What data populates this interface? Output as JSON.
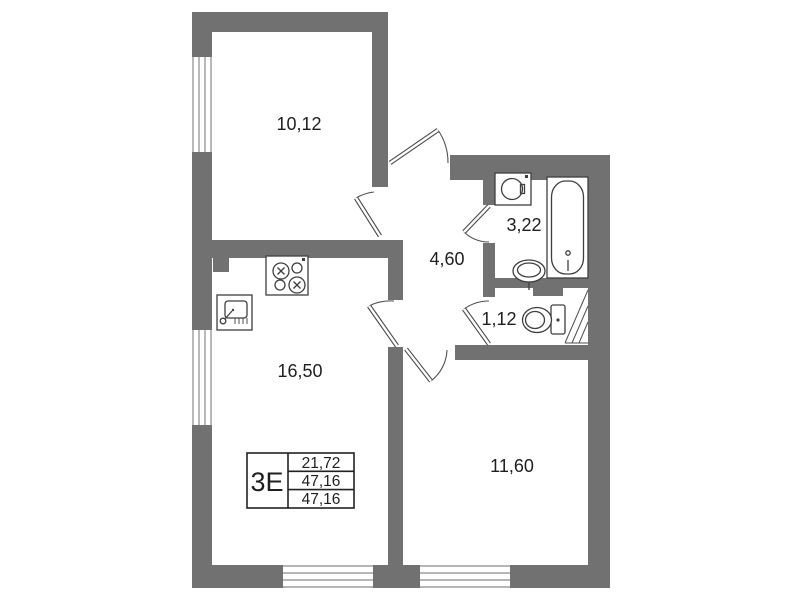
{
  "colors": {
    "wall": "#717171",
    "background": "#ffffff",
    "fixture_line": "#3f3f3f",
    "text": "#1f1f1f"
  },
  "rooms": [
    {
      "name": "top-left-room",
      "area": "10,12"
    },
    {
      "name": "hall",
      "area": "4,60"
    },
    {
      "name": "bathroom",
      "area": "3,22"
    },
    {
      "name": "wc",
      "area": "1,12"
    },
    {
      "name": "kitchen-living",
      "area": "16,50"
    },
    {
      "name": "bedroom",
      "area": "11,60"
    }
  ],
  "stamp": {
    "flat_type": "3E",
    "rows": [
      "21,72",
      "47,16",
      "47,16"
    ]
  },
  "fixtures": [
    "washing-machine",
    "bathtub",
    "washbasin",
    "toilet",
    "stove",
    "kitchen-sink"
  ]
}
